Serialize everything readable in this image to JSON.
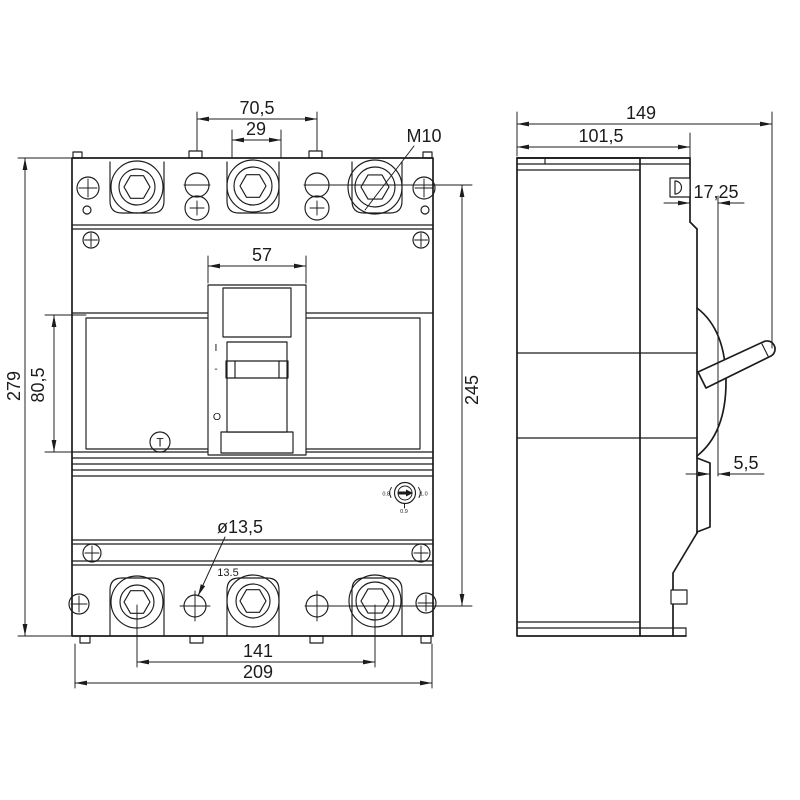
{
  "colors": {
    "line": "#1c1c1c",
    "background": "#ffffff"
  },
  "drawing": {
    "front": {
      "dim_pitch_outer": "70,5",
      "dim_pitch_inner": "29",
      "thread_label": "M10",
      "dim_window_width": "57",
      "dim_height": "279",
      "dim_window_height": "80,5",
      "dim_mount_pitch_v": "245",
      "dim_hole_dia": "ø13,5",
      "dim_hole_note": "13.5",
      "dim_mount_pitch_h": "141",
      "dim_width": "209",
      "marks": {
        "trip": "T",
        "on": "I",
        "dash": "-",
        "off": "O"
      },
      "dial": {
        "low": "0.8",
        "high": "1.0",
        "mid": "0.9"
      }
    },
    "side": {
      "dim_depth": "149",
      "dim_body_depth": "101,5",
      "dim_face_offset": "17,25",
      "dim_rail": "5,5"
    }
  }
}
